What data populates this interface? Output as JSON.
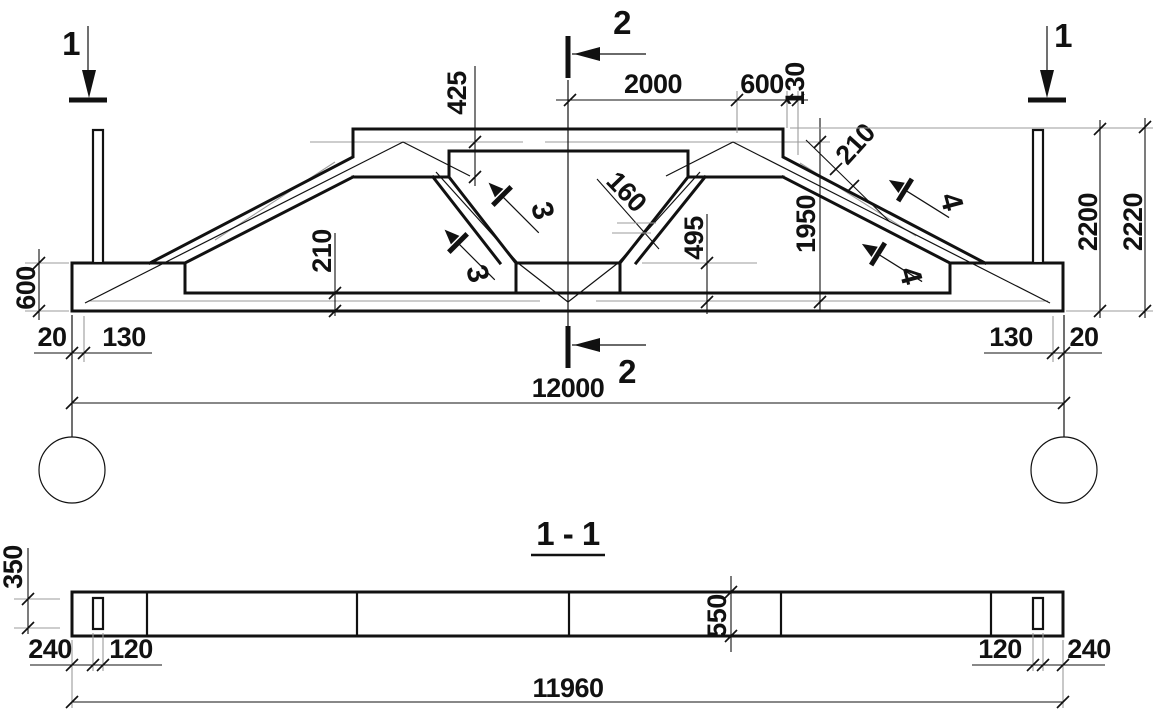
{
  "colors": {
    "ink": "#111111",
    "gray": "#9b9b9b",
    "background": "#ffffff"
  },
  "elevation": {
    "marker_1_left": "1",
    "marker_1_right": "1",
    "marker_2_top": "2",
    "marker_2_bottom": "2",
    "marker_3_upper": "3",
    "marker_3_lower": "3",
    "marker_4_upper": "4",
    "marker_4_lower": "4",
    "dim_top_2000": "2000",
    "dim_top_600": "600",
    "dim_top_130": "130",
    "dim_425": "425",
    "dim_160": "160",
    "dim_495": "495",
    "dim_1950": "1950",
    "dim_210_slope": "210",
    "dim_210_chord": "210",
    "dim_600_end": "600",
    "dim_2200": "2200",
    "dim_2220": "2220",
    "dim_20_left": "20",
    "dim_130_left": "130",
    "dim_130_right": "130",
    "dim_20_right": "20",
    "dim_span_12000": "12000"
  },
  "section_1_1": {
    "title": "1 - 1",
    "dim_350": "350",
    "dim_550": "550",
    "dim_240_left": "240",
    "dim_120_left": "120",
    "dim_120_right": "120",
    "dim_240_right": "240",
    "dim_length_11960": "11960"
  }
}
